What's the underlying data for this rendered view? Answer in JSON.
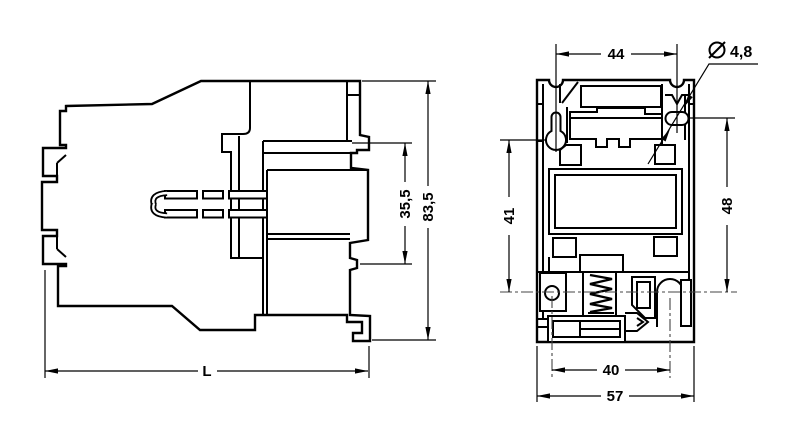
{
  "drawing": {
    "type": "technical dimensional drawing, two views of a contactor",
    "colors": {
      "line": "#000000",
      "background": "#ffffff",
      "centerline": "#444444"
    }
  },
  "dimensions": {
    "top_width": "44",
    "mounting_hole_diameter": "4,8",
    "diameter_symbol": "⌀",
    "side_inner_height": "35,5",
    "side_total_height": "83,5",
    "left_hole_to_centerline": "41",
    "right_hole_to_centerline": "48",
    "base_slot_width": "40",
    "base_width": "57",
    "depth_length": "L"
  }
}
